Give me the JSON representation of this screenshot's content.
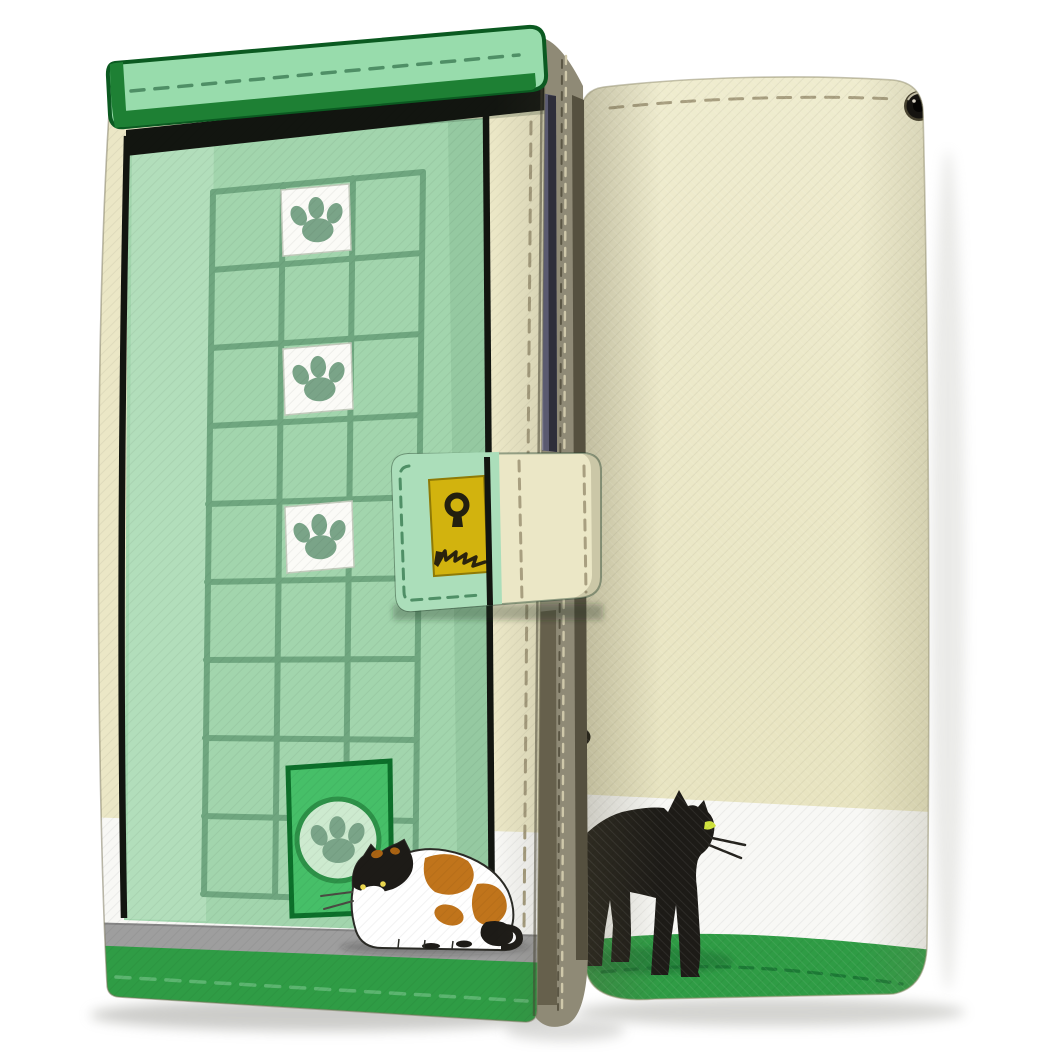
{
  "product": {
    "kind": "wallet-flip-phone-case-product-photo",
    "views": [
      "front-cover-closed",
      "back-cover"
    ],
    "front_design": {
      "scene": "pale green door with window grid",
      "paw_tiles_count": 3,
      "cat": "calico cat crouching by pet door",
      "pet_door": "bright green cat flap with paw emblem",
      "floor": "gray strip",
      "bottom_band": "green with stitching",
      "clasp": "strap with yellow keyhole plate and claw scratch marks"
    },
    "back_design": {
      "cat": "black cat walking with yellow-green eye and whiskers",
      "bands": [
        "cream",
        "white",
        "green"
      ],
      "camera_hole": true,
      "strap_hole": true
    }
  },
  "colors": {
    "page_bg": "#ffffff",
    "cream": "#ebe7c6",
    "cream_back_top": "#efeccf",
    "cream_back": "#e8e4c0",
    "white_band": "#f8f8f5",
    "door_mint": "#a2d5ad",
    "door_mint_light": "#b5dfbd",
    "door_mint_shade": "#92c69e",
    "grid_green": "#6fa67f",
    "flap_green": "#98dcac",
    "flap_edge_green": "#1e8034",
    "dark_green_border": "#0b5a21",
    "outline_black": "#121510",
    "cat_flap_green": "#46bf68",
    "cat_flap_disc": "#cdeacf",
    "cat_flap_ring": "#2d9148",
    "band_green": "#2f9c45",
    "floor_gray": "#9e9e9e",
    "spine_olive": "#8f8a76",
    "spine_dark": "#55503f",
    "phone_slate": "#5a5a70",
    "phone_slate_dark": "#2e2e3a",
    "plate_yellow": "#d2b30e",
    "keyhole_dark": "#23200f",
    "cat_black": "#1d1b17",
    "cat_eye_green": "#cfe23c",
    "calico_eye_yellow": "#edd94f",
    "calico_orange": "#c0741b",
    "calico_orange_dark": "#a96313",
    "calico_white": "#ffffff",
    "paw_green": "#7aa488",
    "tile_white": "#fbfbf7",
    "tile_border": "#c2cbbc",
    "clasp_mint": "#abdeba",
    "stitch_tan": "#a89f80",
    "stitch_green_dark": "#4f8f66",
    "stitch_green_light": "#5cb570",
    "stitch_back_green": "#1c7a35",
    "camera_dark": "#151310",
    "camera_ring": "#7b7560",
    "shadow_gray": "#9a9a94"
  }
}
